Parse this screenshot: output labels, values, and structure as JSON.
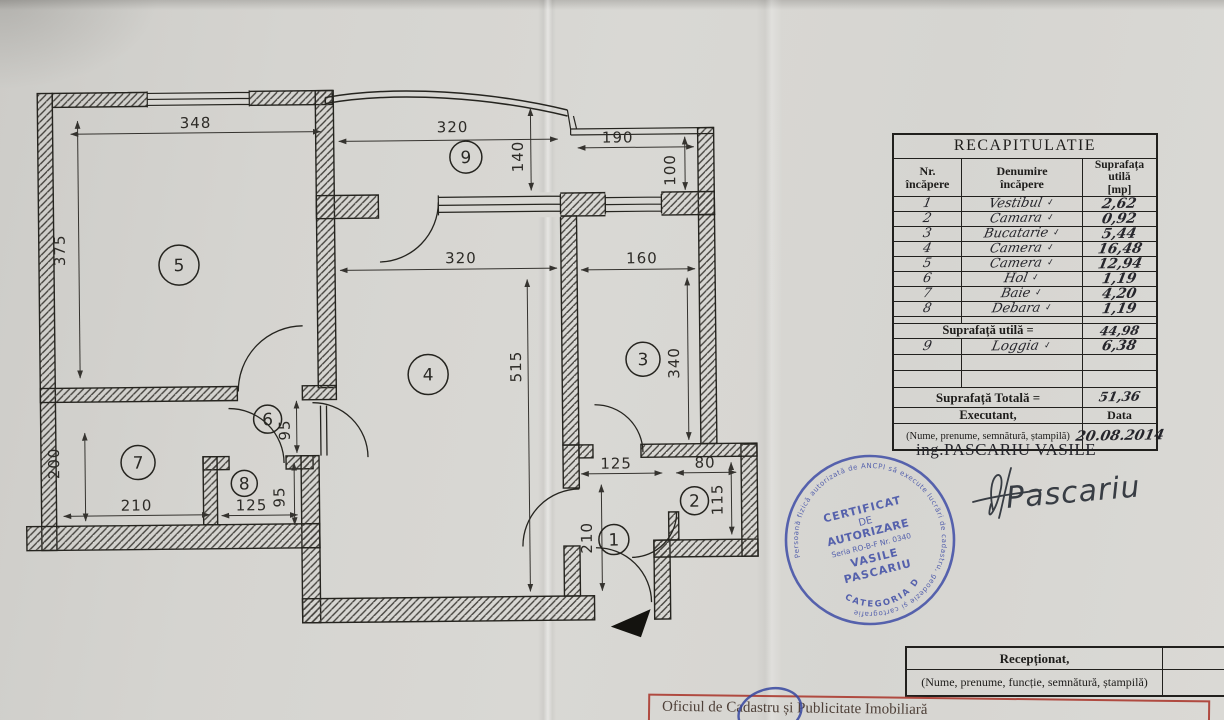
{
  "plan": {
    "rooms": [
      {
        "nr": "1"
      },
      {
        "nr": "2"
      },
      {
        "nr": "3"
      },
      {
        "nr": "4"
      },
      {
        "nr": "5"
      },
      {
        "nr": "6"
      },
      {
        "nr": "7"
      },
      {
        "nr": "8"
      },
      {
        "nr": "9"
      }
    ],
    "dims": [
      {
        "label": "348"
      },
      {
        "label": "375"
      },
      {
        "label": "320"
      },
      {
        "label": "140"
      },
      {
        "label": "190"
      },
      {
        "label": "100"
      },
      {
        "label": "320"
      },
      {
        "label": "160"
      },
      {
        "label": "515"
      },
      {
        "label": "340"
      },
      {
        "label": "200"
      },
      {
        "label": "210"
      },
      {
        "label": "125"
      },
      {
        "label": "95"
      },
      {
        "label": "95"
      },
      {
        "label": "125"
      },
      {
        "label": "80"
      },
      {
        "label": "210"
      },
      {
        "label": "115"
      }
    ]
  },
  "recap": {
    "title": "RECAPITULATIE",
    "col_nr_1": "Nr.",
    "col_nr_2": "încăpere",
    "col_name_1": "Denumire",
    "col_name_2": "încăpere",
    "col_area_1": "Suprafața utilă",
    "col_area_2": "[mp]",
    "rows": [
      {
        "nr": "1",
        "name": "Vestibul",
        "tick": "✓",
        "area": "2,62"
      },
      {
        "nr": "2",
        "name": "Camara",
        "tick": "✓",
        "area": "0,92"
      },
      {
        "nr": "3",
        "name": "Bucatarie",
        "tick": "✓",
        "area": "5,44"
      },
      {
        "nr": "4",
        "name": "Camera",
        "tick": "✓",
        "area": "16,48"
      },
      {
        "nr": "5",
        "name": "Camera",
        "tick": "✓",
        "area": "12,94"
      },
      {
        "nr": "6",
        "name": "Hol",
        "tick": "✓",
        "area": "1,19"
      },
      {
        "nr": "7",
        "name": "Baie",
        "tick": "✓",
        "area": "4,20"
      },
      {
        "nr": "8",
        "name": "Debara",
        "tick": "✓",
        "area": "1,19"
      }
    ],
    "subtotal_label": "Suprafață utilă =",
    "subtotal_value": "44,98",
    "row9": {
      "nr": "9",
      "name": "Loggia",
      "tick": "✓",
      "area": "6,38"
    },
    "total_label": "Suprafață Totală =",
    "total_value": "51,36",
    "exec_label": "Executant,",
    "data_label": "Data",
    "note": "(Nume, prenume, semnătură, ștampilă)",
    "date": "20.08.2014",
    "engineer": "ing.PASCARIU VASILE"
  },
  "stamp": {
    "ring": "Persoană fizică autorizată de ANCPI să execute lucrări de cadastru, geodezie și cartografie",
    "line1": "CERTIFICAT",
    "line2": "DE",
    "line3": "AUTORIZARE",
    "line4": "Seria RO-B-F Nr. 0340",
    "line5": "VASILE",
    "line6": "PASCARIU",
    "category": "CATEGORIA D",
    "color": "#4452a8"
  },
  "signature_name": "Pascariu",
  "reception": {
    "label": "Recepționat,",
    "data_label": "Data",
    "note": "(Nume, prenume, funcție, semnătură, ștampilă)"
  },
  "footer": {
    "text": "Oficiul de Cadastru și Publicitate Imobiliară"
  }
}
